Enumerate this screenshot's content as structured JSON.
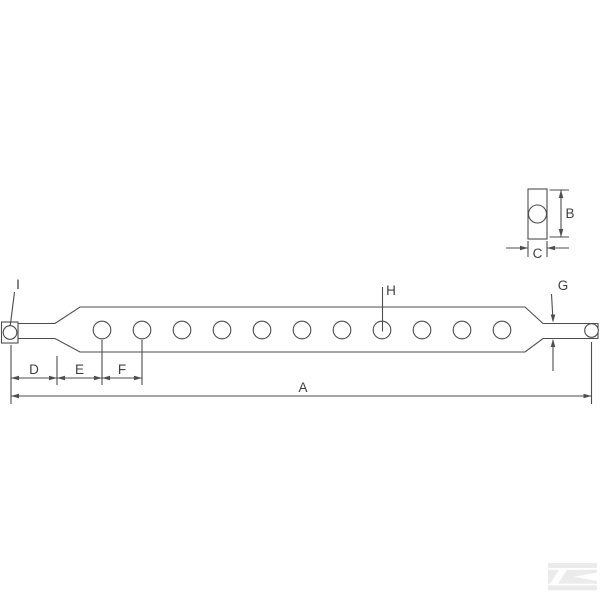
{
  "labels": {
    "a": "A",
    "b": "B",
    "c": "C",
    "d": "D",
    "e": "E",
    "f": "F",
    "g": "G",
    "h": "H",
    "i": "I"
  },
  "colors": {
    "line": "#4d4d4d",
    "text": "#404040",
    "watermark": "#ebebeb",
    "background": "#ffffff"
  },
  "drawing": {
    "hole_count": 11
  }
}
